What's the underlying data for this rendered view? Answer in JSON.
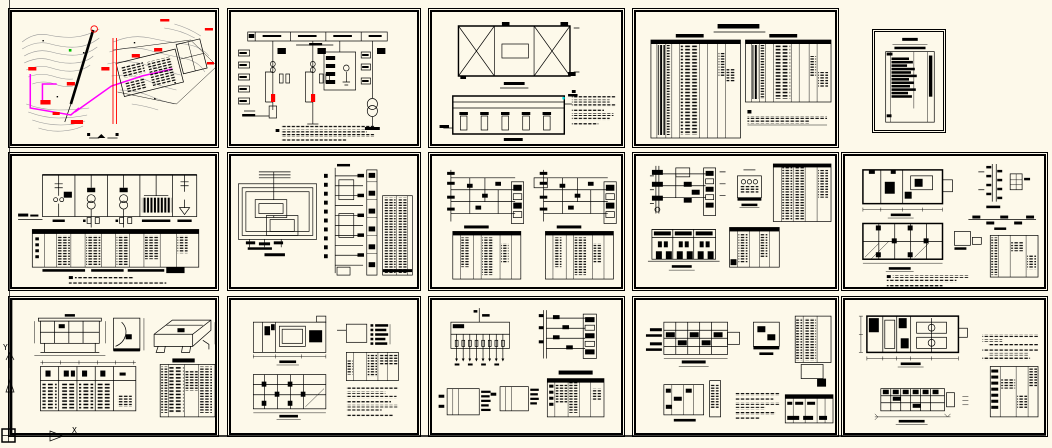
{
  "colors": {
    "bg": "#fdf9ea",
    "ink": "#000000",
    "red": "#ff0000",
    "mag": "#ff00ff",
    "topo": "#999999",
    "cyan": "#00e0e0",
    "grn": "#00c000"
  },
  "axis": {
    "x_label": "X",
    "y_label": "Y"
  },
  "sheets": [
    {
      "id": "r1c1",
      "kind": "site plan with topographic contours and cable route"
    },
    {
      "id": "r1c2",
      "kind": "high-voltage single line diagram with notes"
    },
    {
      "id": "r1c3",
      "kind": "structure roof plan and building section"
    },
    {
      "id": "r1c4",
      "kind": "equipment and material schedule tables"
    },
    {
      "id": "r1c5",
      "kind": "small schedule sheet"
    },
    {
      "id": "r2c1",
      "kind": "transformer bay single line diagram with schedule table"
    },
    {
      "id": "r2c2",
      "kind": "grounding grid plan, control riser and schedule"
    },
    {
      "id": "r2c3",
      "kind": "two panel wiring diagrams with schedules"
    },
    {
      "id": "r2c4",
      "kind": "protection circuits, transformer detail and panel elevation"
    },
    {
      "id": "r2c5",
      "kind": "substation room plans and installation details"
    },
    {
      "id": "r3c1",
      "kind": "control console elevations and panel layout"
    },
    {
      "id": "r3c2",
      "kind": "room layout plans with detail and notes"
    },
    {
      "id": "r3c3",
      "kind": "distribution box diagram, terminal strips and table"
    },
    {
      "id": "r3c4",
      "kind": "installation details and schedules"
    },
    {
      "id": "r3c5",
      "kind": "powerhouse plan, section and equipment schedule"
    }
  ]
}
